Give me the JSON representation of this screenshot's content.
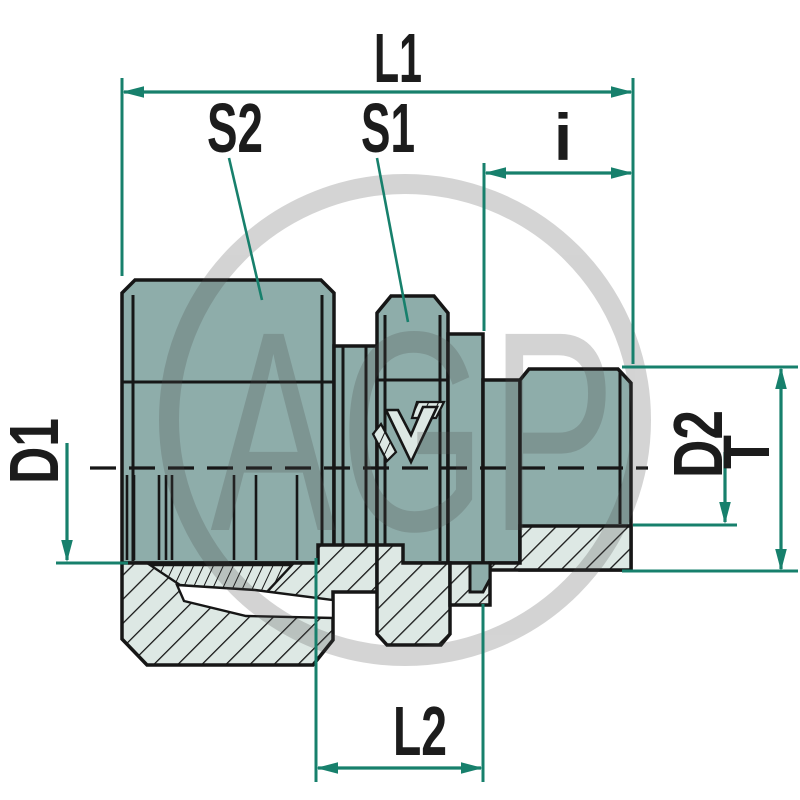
{
  "diagram": {
    "description": "Technical cross-section drawing of a hydraulic male stud coupling fitting",
    "watermark_text": "AGP",
    "labels": {
      "l1": "L1",
      "s2": "S2",
      "s1": "S1",
      "i": "i",
      "d1": "D1",
      "d2": "D2",
      "t": "T",
      "l2": "L2"
    }
  },
  "colors": {
    "background": "#ffffff",
    "body_teal": "#8eadaa",
    "hatch_bg": "#dde8e4",
    "outline": "#161616",
    "dimension_green": "#17806c",
    "label_black": "#1c1c1c",
    "watermark_grey": "#4a4a4a"
  }
}
